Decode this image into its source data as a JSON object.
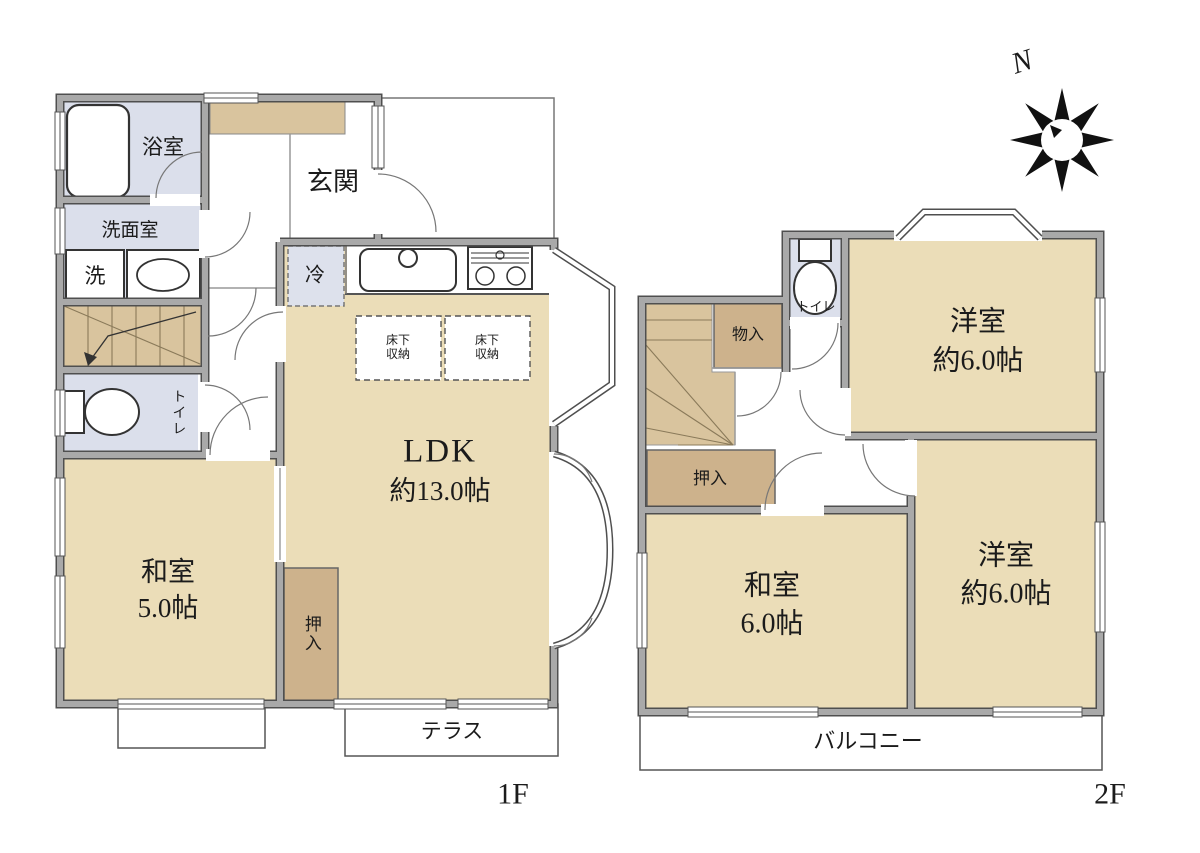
{
  "colors": {
    "room_beige": "#EBDDB8",
    "closet_tan": "#CDB28C",
    "stairs_tan": "#D9C49E",
    "wet_area_blue": "#DBDFEB",
    "wall_gray": "#A9A9A9",
    "wall_edge": "#4F4F4F",
    "line_thin": "#666666",
    "text": "#1B1B1B"
  },
  "compass": {
    "label": "N"
  },
  "floor1": {
    "floor_label": "1F",
    "bath": "浴室",
    "washroom": "洗面室",
    "washer": "洗",
    "entrance": "玄関",
    "fridge": "冷",
    "toilet": "トイレ",
    "japanese_room": "和室",
    "japanese_room_size": "5.0帖",
    "closet": "押入",
    "ldk": "LDK",
    "ldk_size": "約13.0帖",
    "underfloor1_line1": "床下",
    "underfloor1_line2": "収納",
    "underfloor2_line1": "床下",
    "underfloor2_line2": "収納",
    "terrace": "テラス"
  },
  "floor2": {
    "floor_label": "2F",
    "storage": "物入",
    "toilet": "トイレ",
    "western_room_top": "洋室",
    "western_room_top_size": "約6.0帖",
    "closet": "押入",
    "japanese_room": "和室",
    "japanese_room_size": "6.0帖",
    "western_room_bottom": "洋室",
    "western_room_bottom_size": "約6.0帖",
    "balcony": "バルコニー"
  }
}
